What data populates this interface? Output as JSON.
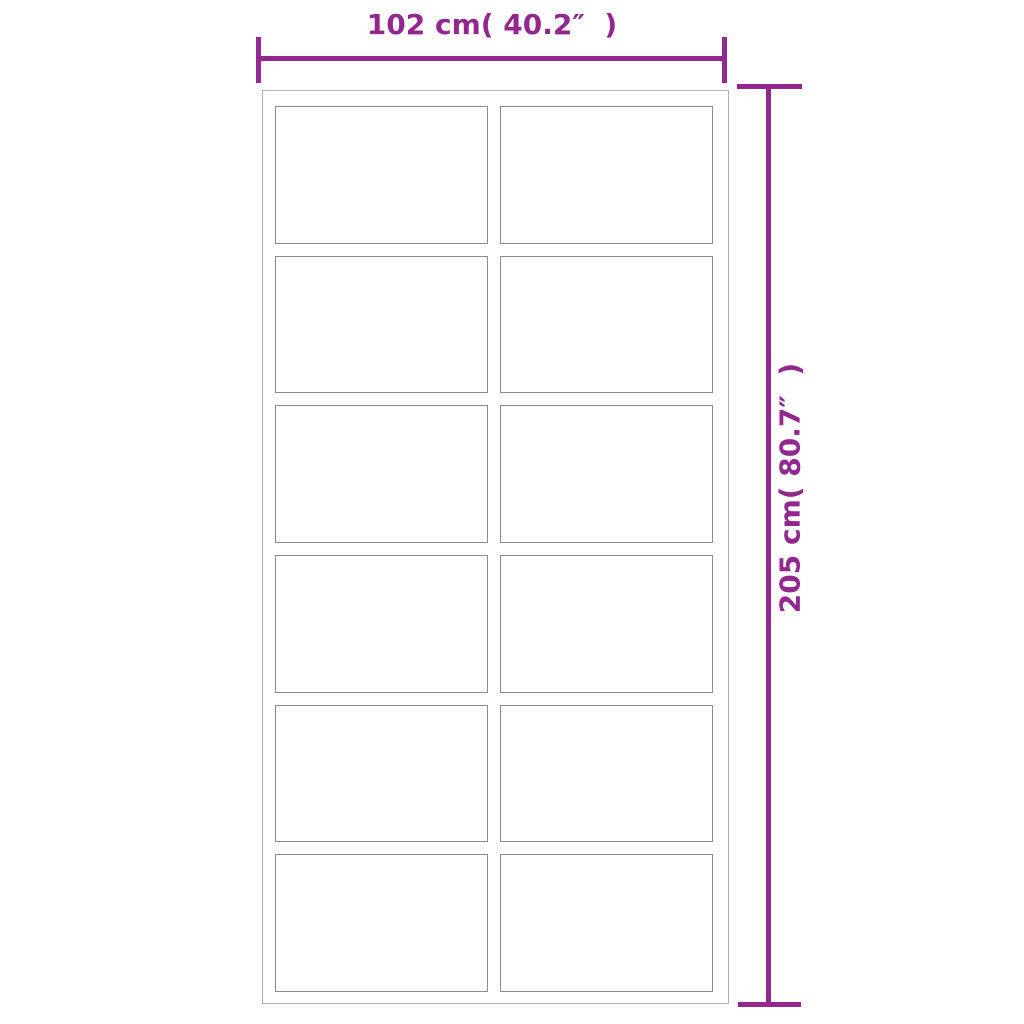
{
  "diagram": {
    "width_label": "102 cm( 40.2″  )",
    "height_label": "205 cm( 80.7″  )",
    "grid": {
      "rows": 6,
      "columns": 2,
      "panel_count": 12
    },
    "colors": {
      "dimension_accent": "#92278F",
      "door_frame_border": "#b0b0b0",
      "panel_border": "#8a8a8a",
      "background": "#ffffff"
    }
  }
}
